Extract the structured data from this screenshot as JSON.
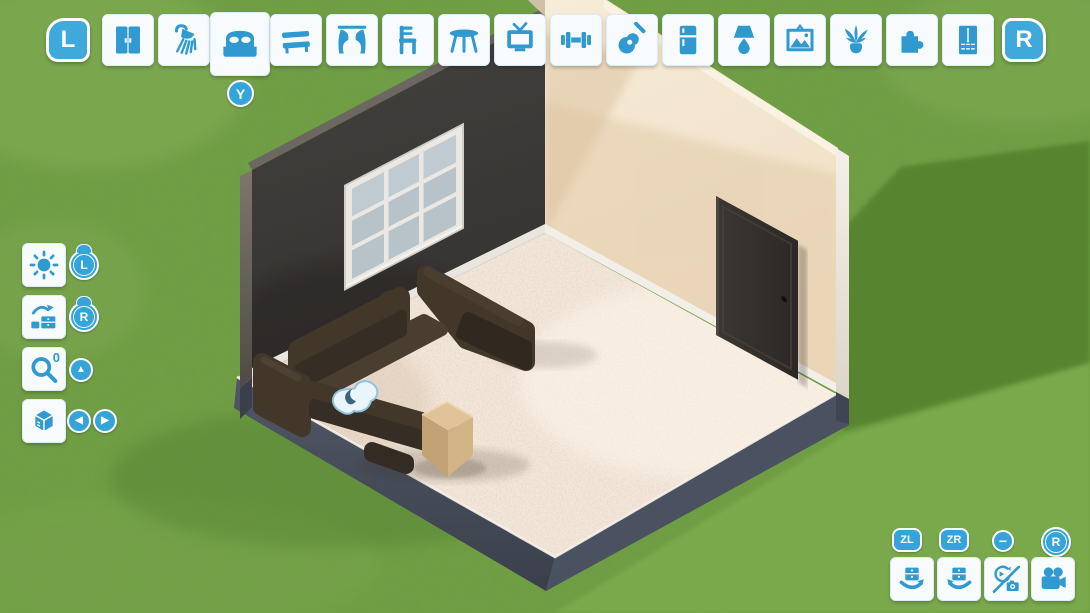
{
  "meta": {
    "app": "room-builder-game",
    "view": "isometric-room-editor"
  },
  "colors": {
    "accent_blue": "#2f99d0",
    "hint_blue": "#35a4da",
    "button_bg": "#f7fbfd",
    "grass": "#6f9e44",
    "grass_shadow": "#54832e",
    "grass_light": "#7cab4e",
    "wall_dark": "#3c3a37",
    "wall_cream": "#f2e3cb",
    "carpet": "#f1e7da",
    "slab_side": "#454b58",
    "couch_brown": "#423729",
    "side_table_tan": "#d9bc92",
    "door_brown": "#33302c"
  },
  "top_toolbar": {
    "left_shoulder": {
      "label": "L"
    },
    "right_shoulder": {
      "label": "R"
    },
    "select_hint": {
      "label": "Y"
    },
    "selected_index": 2,
    "categories": [
      {
        "icon": "wardrobe-doors-icon"
      },
      {
        "icon": "shower-icon"
      },
      {
        "icon": "bed-icon",
        "selected": true
      },
      {
        "icon": "bench-icon"
      },
      {
        "icon": "curtains-icon"
      },
      {
        "icon": "chair-icon"
      },
      {
        "icon": "table-icon"
      },
      {
        "icon": "tv-icon"
      },
      {
        "icon": "dumbbell-icon"
      },
      {
        "icon": "guitar-icon"
      },
      {
        "icon": "fridge-icon"
      },
      {
        "icon": "lamp-icon"
      },
      {
        "icon": "picture-frame-icon"
      },
      {
        "icon": "plant-icon"
      },
      {
        "icon": "puzzle-icon"
      },
      {
        "icon": "tall-dresser-icon"
      }
    ]
  },
  "left_panel": {
    "rows": [
      {
        "icon": "sun-icon",
        "hint": "L",
        "hint_type": "left-stick"
      },
      {
        "icon": "furniture-place-icon",
        "hint": "R",
        "hint_type": "right-stick"
      },
      {
        "icon": "magnifier-icon",
        "zoom_level": "0",
        "hint": "▲"
      },
      {
        "icon": "cube-icon",
        "hints": [
          "◀",
          "▶"
        ]
      }
    ]
  },
  "bottom_right_panel": {
    "buttons": [
      {
        "hint": "ZL",
        "icon": "rotate-clockwise-icon"
      },
      {
        "hint": "ZR",
        "icon": "rotate-counterclockwise-icon"
      },
      {
        "hint": "−",
        "icon": "camera-mode-toggle-icon"
      },
      {
        "hint": "R",
        "hint_type": "right-stick",
        "icon": "video-camera-icon"
      }
    ]
  },
  "scene": {
    "room": {
      "left_wall": "dark-gray",
      "right_wall": "cream",
      "floor": "speckled-carpet",
      "furniture": [
        "corner-sofa",
        "ottoman",
        "side-table-cube",
        "door",
        "window"
      ],
      "cursor": "hand-cursor"
    }
  }
}
